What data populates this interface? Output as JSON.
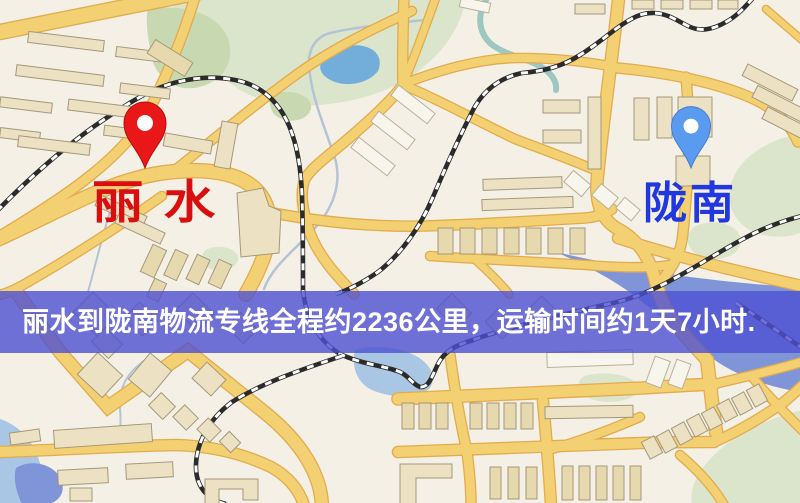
{
  "banner": {
    "text": "丽水到陇南物流专线全程约2236公里，运输时间约1天7小时."
  },
  "markers": {
    "origin": {
      "name": "丽水"
    },
    "destination": {
      "name": "陇南"
    }
  },
  "colors": {
    "map-bg": "#f4f0e6",
    "park": "#dbe5cb",
    "park-dark": "#c8d9b2",
    "water-pond": "#72aed9",
    "water-light": "#a9c6e4",
    "water-deep": "#8094d8",
    "stream": "#b4c3d6",
    "stream-teal": "#8fc0bb",
    "road-fill": "#f3d173",
    "road-edge": "#e2ab4e",
    "rail": "#2b2b2b",
    "building-fill": "#ece1c2",
    "building-slat": "#e7d9ae",
    "building-white": "#f8f5ec",
    "building-edge": "#a5987a",
    "banner-bg": "#4e50d2",
    "banner-text": "#ffffff",
    "origin-pin": "#e91717",
    "origin-label": "#d90f0f",
    "dest-pin": "#5a9bf0",
    "dest-label": "#2038dd"
  }
}
